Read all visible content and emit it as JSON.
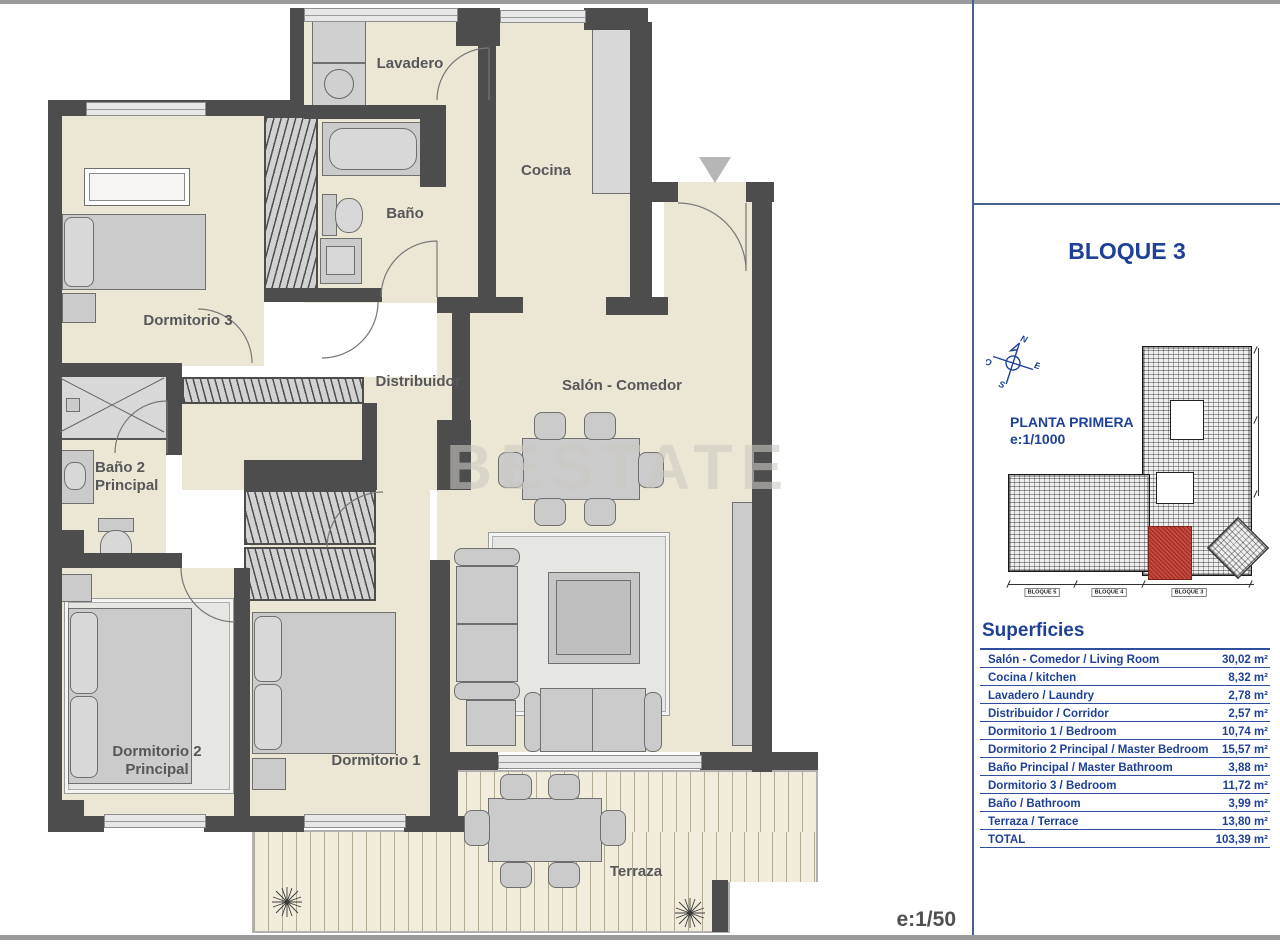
{
  "plan": {
    "watermark": "BESTATE",
    "scale": "e:1/50",
    "rooms": {
      "lavadero": "Lavadero",
      "cocina": "Cocina",
      "bano": "Baño",
      "dormitorio3": "Dormitorio 3",
      "distribuidor": "Distribuidor",
      "salon_comedor": "Salón - Comedor",
      "bano2_l1": "Baño 2",
      "bano2_l2": "Principal",
      "dormitorio2_l1": "Dormitorio 2",
      "dormitorio2_l2": "Principal",
      "dormitorio1": "Dormitorio 1",
      "terraza": "Terraza"
    }
  },
  "sidebar": {
    "block_title": "BLOQUE 3",
    "compass": {
      "n": "N",
      "e": "E",
      "s": "S",
      "o": "O"
    },
    "site_plan": {
      "title": "PLANTA PRIMERA",
      "scale": "e:1/1000",
      "block_labels": [
        "BLOQUE 5",
        "BLOQUE 4",
        "BLOQUE 3"
      ]
    },
    "surfaces": {
      "title": "Superficies",
      "rows": [
        {
          "label": "Salón - Comedor / Living Room",
          "value": "30,02 m²"
        },
        {
          "label": "Cocina / kitchen",
          "value": "8,32 m²"
        },
        {
          "label": "Lavadero / Laundry",
          "value": "2,78 m²"
        },
        {
          "label": "Distribuidor / Corridor",
          "value": "2,57 m²"
        },
        {
          "label": "Dormitorio 1 / Bedroom",
          "value": "10,74 m²"
        },
        {
          "label": "Dormitorio 2 Principal / Master Bedroom",
          "value": "15,57 m²"
        },
        {
          "label": "Baño Principal / Master Bathroom",
          "value": "3,88 m²"
        },
        {
          "label": "Dormitorio 3 / Bedroom",
          "value": "11,72 m²"
        },
        {
          "label": "Baño / Bathroom",
          "value": "3,99 m²"
        },
        {
          "label": "Terraza / Terrace",
          "value": "13,80 m²"
        },
        {
          "label": "TOTAL",
          "value": "103,39 m²"
        }
      ]
    }
  },
  "colors": {
    "accent_blue": "#1e4097",
    "wall_gray": "#4d4d4d",
    "floor_cream": "#ece7d5",
    "highlight_red": "#c44b40",
    "watermark_gray": "#ccc9c2"
  }
}
